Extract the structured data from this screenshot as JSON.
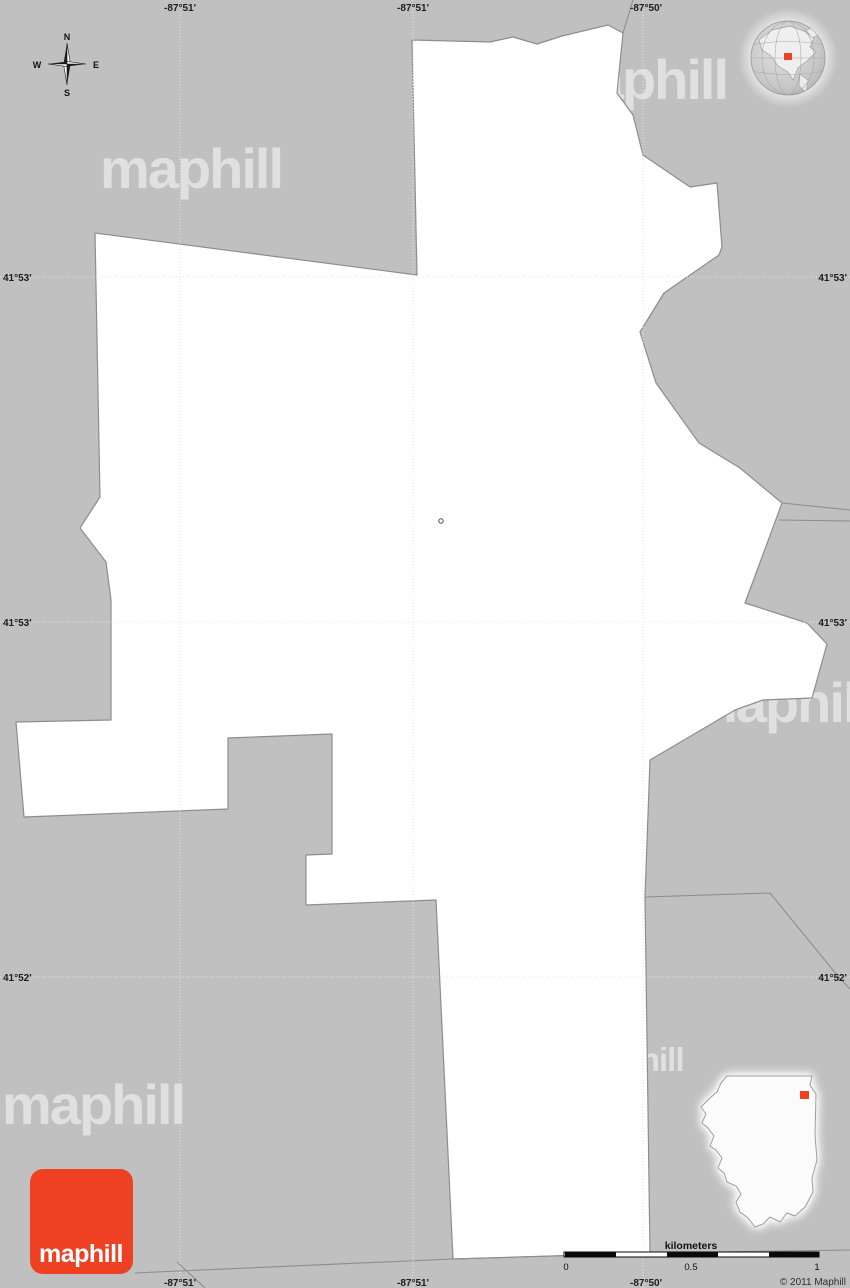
{
  "colors": {
    "background": "#c0c0c0",
    "map_fill": "#ffffff",
    "boundary": "#8d8d8d",
    "accent_red": "#ee4123",
    "scale_black": "#0a0a0a",
    "label_text": "#1c1c1c"
  },
  "grid": {
    "top": [
      "-87°51'",
      "-87°51'",
      "-87°50'"
    ],
    "bottom": [
      "-87°51'",
      "-87°51'",
      "-87°50'"
    ],
    "left": [
      "41°53'",
      "41°53'",
      "41°52'"
    ],
    "right": [
      "41°53'",
      "41°53'",
      "41°52'"
    ]
  },
  "compass": {
    "n": "N",
    "e": "E",
    "s": "S",
    "w": "W"
  },
  "watermark": {
    "text": "maphill"
  },
  "logo": {
    "text": "maphill"
  },
  "scale": {
    "unit_label": "kilometers",
    "ticks": [
      "0",
      "0.5",
      "1"
    ]
  },
  "copyright": "© 2011 Maphill",
  "icons": {
    "compass": "compass-rose-icon",
    "globe": "globe-locator-icon",
    "state_inset": "illinois-state-inset",
    "center_marker": "map-center-marker"
  }
}
